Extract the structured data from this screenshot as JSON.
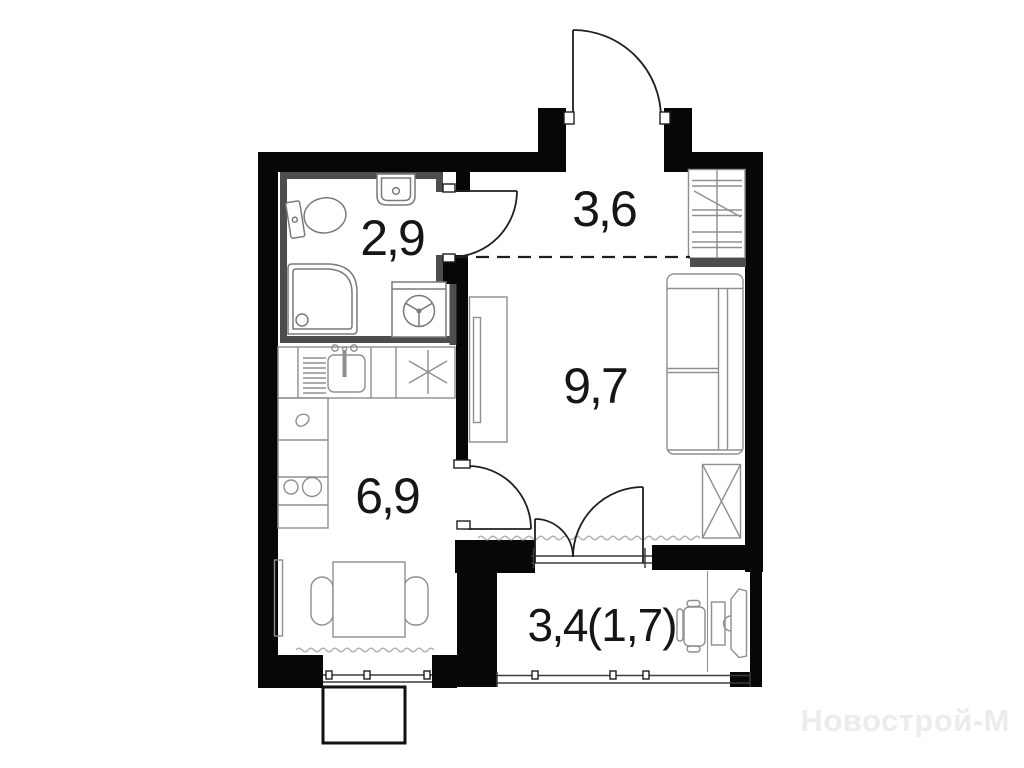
{
  "plan": {
    "title": "studio-apartment-floor-plan",
    "rooms": {
      "bathroom": {
        "area": "2,9"
      },
      "hallway": {
        "area": "3,6"
      },
      "living_room": {
        "area": "9,7"
      },
      "kitchen": {
        "area": "6,9"
      },
      "balcony": {
        "area_total": "3,4",
        "area_counted": "(1,7)"
      }
    },
    "icons": [
      "toilet",
      "wash-basin",
      "shower-tray",
      "washing-machine",
      "dish-rack",
      "kitchen-sink",
      "burner-asterisk",
      "hob-burners",
      "dining-table",
      "chair",
      "radiator",
      "wardrobe",
      "sliding-wardrobe",
      "sofa-bed",
      "x-cabinet",
      "desk",
      "office-chair",
      "entrance-door",
      "interior-door",
      "balcony-door",
      "window",
      "zoning-dashed-line",
      "sill-wave"
    ]
  },
  "watermark": {
    "text": "Новострой-М"
  },
  "colors": {
    "wall": "#070707",
    "partition": "#4d4d4d",
    "furniture": "#8f8f8f",
    "fixture": "#7a7a7a",
    "door": "#1f1f1f",
    "frame": "#3c3c3c",
    "wave": "#b3b3b3",
    "label": "#161616",
    "watermark": "#ececec"
  }
}
